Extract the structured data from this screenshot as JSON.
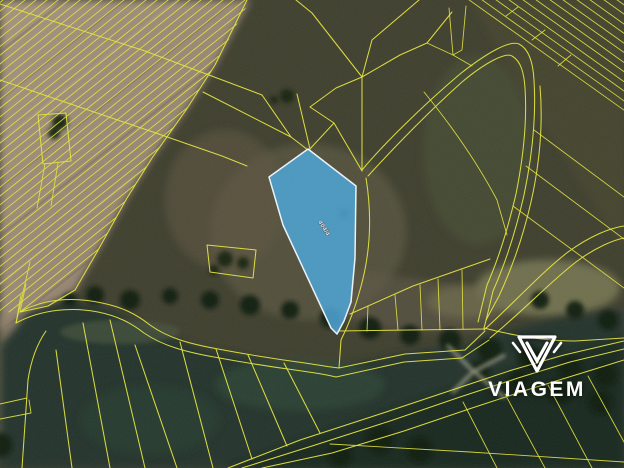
{
  "theme": {
    "cadastral-line": "#e4e53b",
    "parcel-fill": "#49a4d9",
    "parcel-stroke": "#edf4fa",
    "watermark-color": "#ffffff"
  },
  "map": {
    "type": "aerial-cadastral-map",
    "parcel_label": "404/4"
  },
  "watermark": {
    "brand": "VIAGEM",
    "icon": "viagem-shield-icon"
  }
}
